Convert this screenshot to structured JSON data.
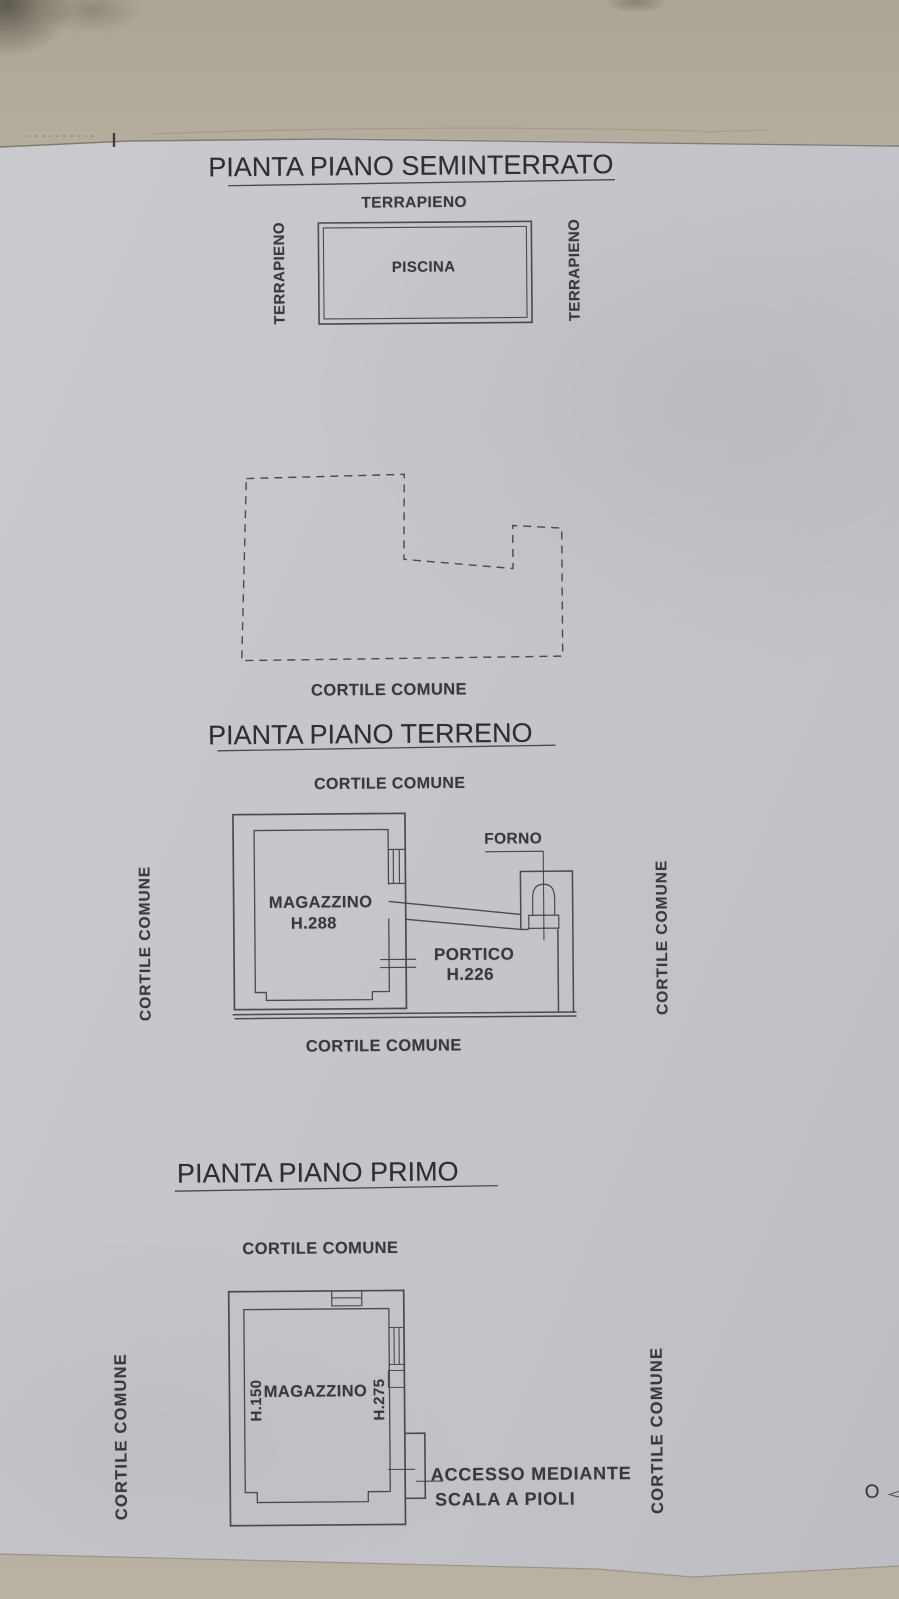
{
  "document_type": "planimetria catastale (photographed floor-plan sheet)",
  "colors": {
    "paper": "#c7c6cb",
    "background": "#b4ac9c",
    "ink": "#3f3f45"
  },
  "seminterrato": {
    "title": "PIANTA PIANO SEMINTERRATO",
    "terrapieno_top": "TERRAPIENO",
    "terrapieno_left": "TERRAPIENO",
    "terrapieno_right": "TERRAPIENO",
    "piscina": "PISCINA",
    "cortile_bottom": "CORTILE COMUNE"
  },
  "terreno": {
    "title": "PIANTA PIANO TERRENO",
    "cortile_top": "CORTILE COMUNE",
    "cortile_left": "CORTILE COMUNE",
    "cortile_right": "CORTILE COMUNE",
    "cortile_bottom": "CORTILE COMUNE",
    "magazzino": "MAGAZZINO",
    "magazzino_h": "H.288",
    "forno": "FORNO",
    "portico": "PORTICO",
    "portico_h": "H.226"
  },
  "primo": {
    "title": "PIANTA PIANO PRIMO",
    "cortile_top": "CORTILE COMUNE",
    "cortile_left": "CORTILE COMUNE",
    "cortile_right": "CORTILE COMUNE",
    "magazzino": "MAGAZZINO",
    "h_left": "H.150",
    "h_right": "H.275",
    "accesso_line1": "ACCESSO MEDIANTE",
    "accesso_line2": "SCALA A PIOLI"
  },
  "margin_mark": {
    "label": "O"
  }
}
